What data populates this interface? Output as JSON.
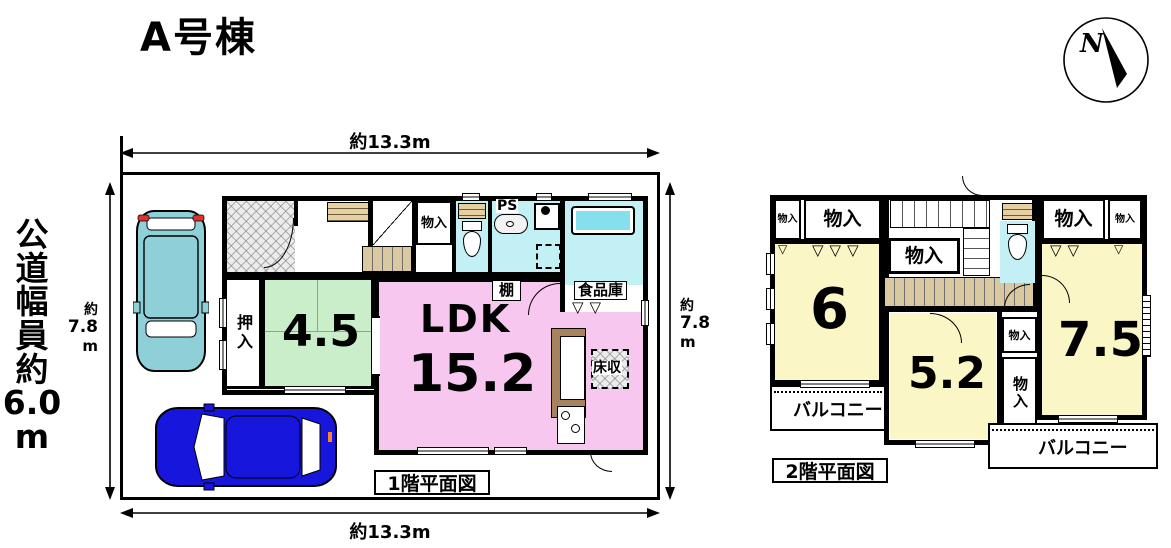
{
  "title": "A号棟",
  "compass": {
    "label": "N"
  },
  "road_label_chars": [
    "公",
    "道",
    "幅",
    "員",
    "約",
    "6.0",
    "m"
  ],
  "dims": {
    "top": "約13.3m",
    "bottom": "約13.3m",
    "left": [
      "約",
      "7.8",
      "m"
    ],
    "right": [
      "約",
      "7.8",
      "m"
    ]
  },
  "floor1": {
    "caption": "1階平面図",
    "ldk_name": "LDK",
    "ldk_size": "15.2",
    "tatami_size": "4.5",
    "oshiire": "押入",
    "monoire": "物入",
    "ps": "PS",
    "tana": "棚",
    "pantry": "食品庫",
    "floor_storage": "床収"
  },
  "floor2": {
    "caption": "2階平面図",
    "room6": "6",
    "room52": "5.2",
    "room75": "7.5",
    "monoire": "物入",
    "balcony": "バルコニー"
  },
  "icons": {
    "bifold_door_3": "▽▽▽",
    "bifold_door_2": "▽▽",
    "bifold_door_1": "▽"
  },
  "colors": {
    "tatami_green": "#c9eec9",
    "ldk_pink": "#f8c7f0",
    "water_cyan": "#c2f0f4",
    "tub_cyan": "#85dfec",
    "room_yellow": "#faf6c5",
    "stair_tan": "#d9c8a0",
    "wood_strip": "#e6cfa0",
    "car_teal": "#8fd0d8",
    "car_blue": "#1616dd",
    "tail_red": "#e03030"
  }
}
